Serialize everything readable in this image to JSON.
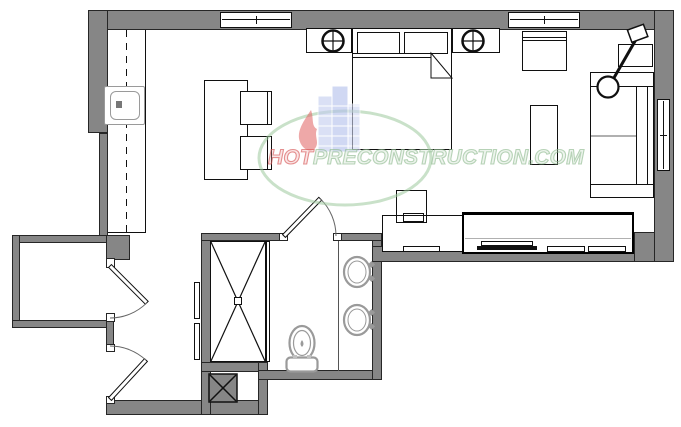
{
  "watermark": {
    "brand_prefix": "HOT",
    "brand_suffix": "PRECONSTRUCTION.COM",
    "full_text": "HOTPRECONSTRUCTION.COM"
  },
  "colors": {
    "wall_fill": "#868686",
    "line_black": "#101010",
    "fixture_gray": "#9a9a9a",
    "divider_gray": "#b0b0b0",
    "watermark_green": "#91bc91",
    "watermark_red": "#d65454",
    "watermark_blue": "#bcc8ee",
    "background": "#ffffff"
  },
  "symbols": {
    "windows": [
      "top-window-left",
      "top-window-right",
      "right-wall-window"
    ],
    "doors": [
      "closet-swing-door",
      "entry-swing-door",
      "bathroom-swing-door"
    ],
    "kitchen": [
      "kitchen-counter",
      "upper-cabinet-dash-line",
      "kitchen-sink"
    ],
    "dining": [
      "dining-table",
      "dining-chair",
      "dining-chair"
    ],
    "bedroom": [
      "double-bed",
      "pillow",
      "pillow",
      "blanket-fold",
      "nightstand-left",
      "nightstand-right",
      "table-lamp",
      "table-lamp"
    ],
    "living": [
      "armchair",
      "coffee-table",
      "sofa",
      "side-table",
      "arc-floor-lamp",
      "desk",
      "desk-chair",
      "keyboard",
      "tv-console",
      "flat-tv",
      "media-device",
      "media-device"
    ],
    "bathroom": [
      "shower-stall",
      "shower-glass-door",
      "vanity-counter",
      "basin-sink",
      "basin-sink",
      "faucet",
      "toilet",
      "sliding-panels"
    ],
    "utility": [
      "laundry-shaft-square"
    ]
  }
}
